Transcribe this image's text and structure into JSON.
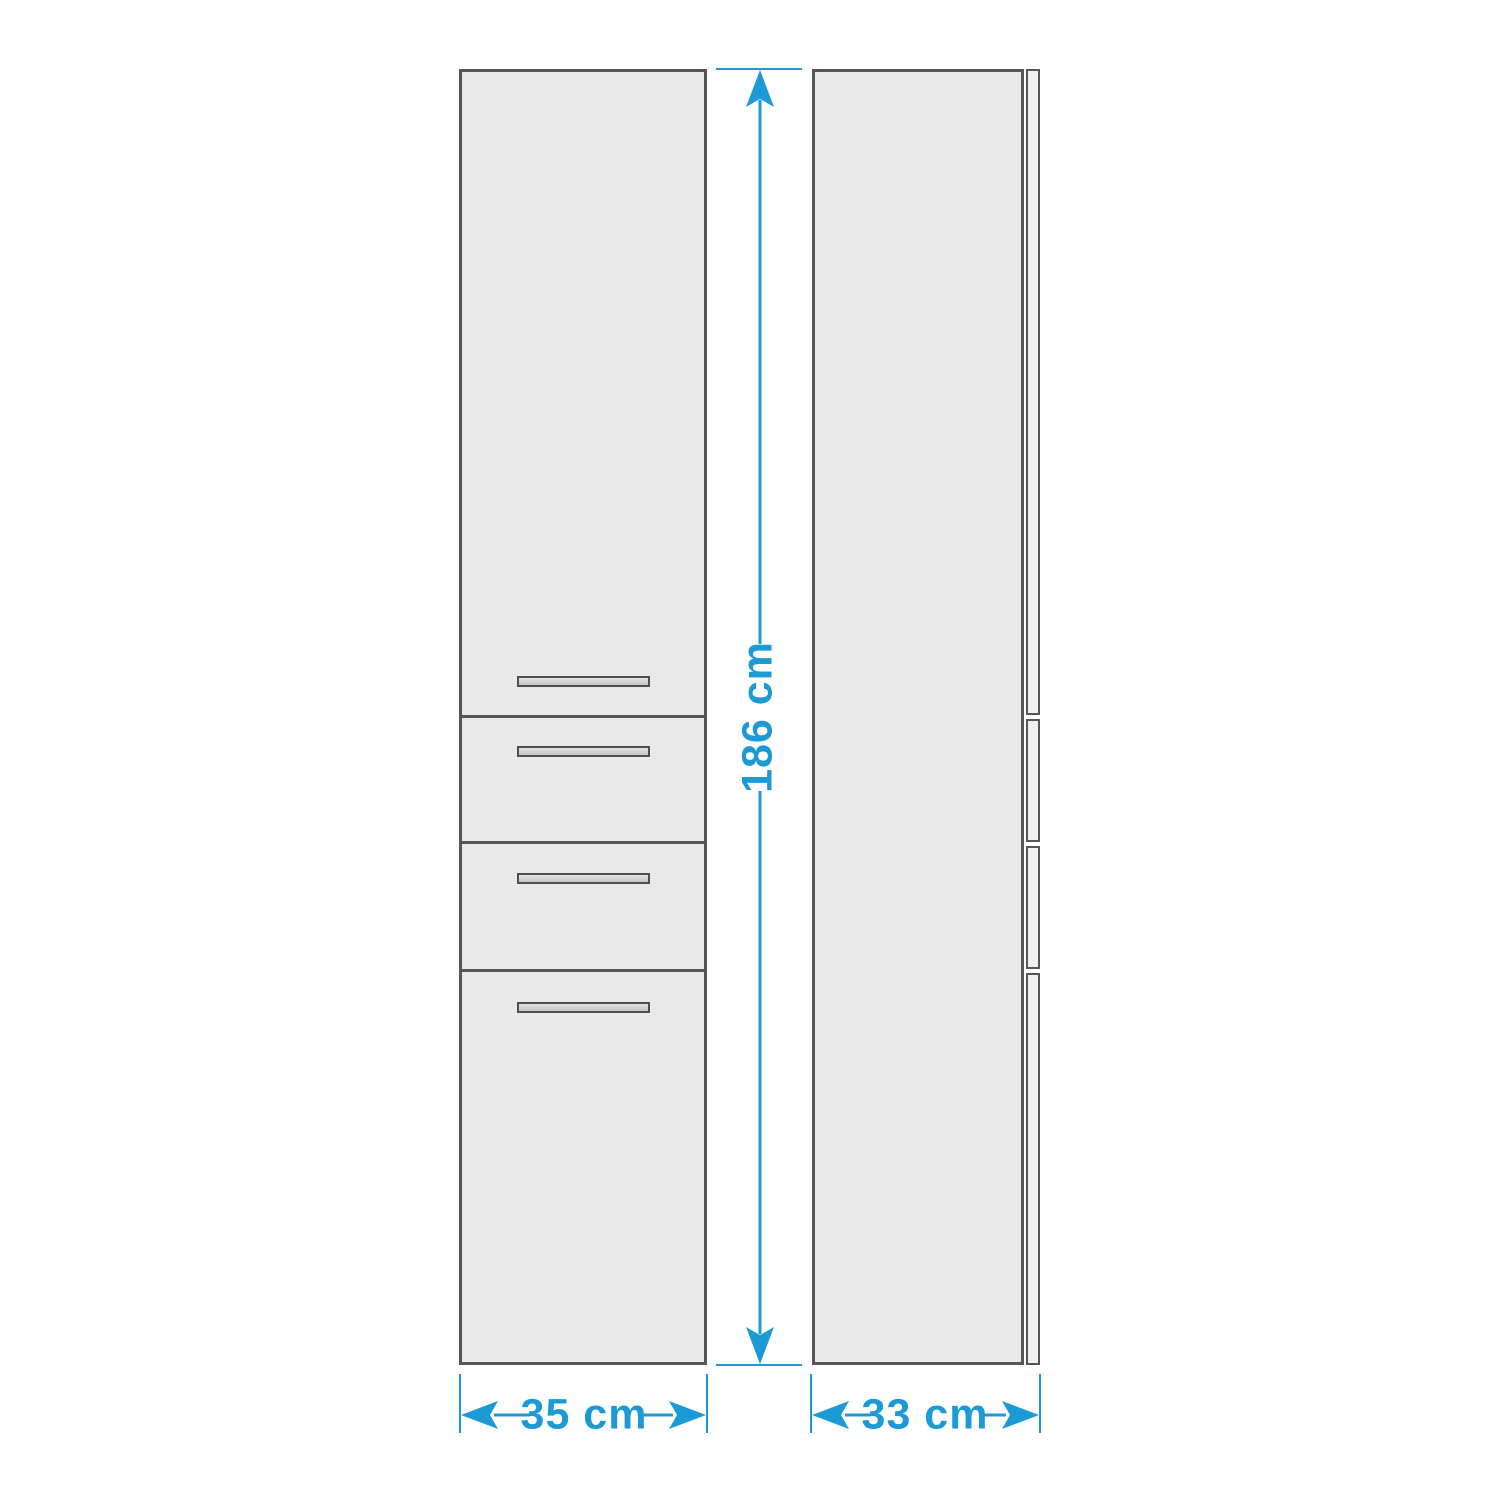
{
  "colors": {
    "background": "#ffffff",
    "accent": "#1c9ad6",
    "cabinet-fill": "#e9e9e9",
    "cabinet-border": "#565656",
    "panel-fill": "#f0f0f0"
  },
  "labels": {
    "height": "186 cm",
    "width": "35 cm",
    "depth": "33 cm"
  }
}
